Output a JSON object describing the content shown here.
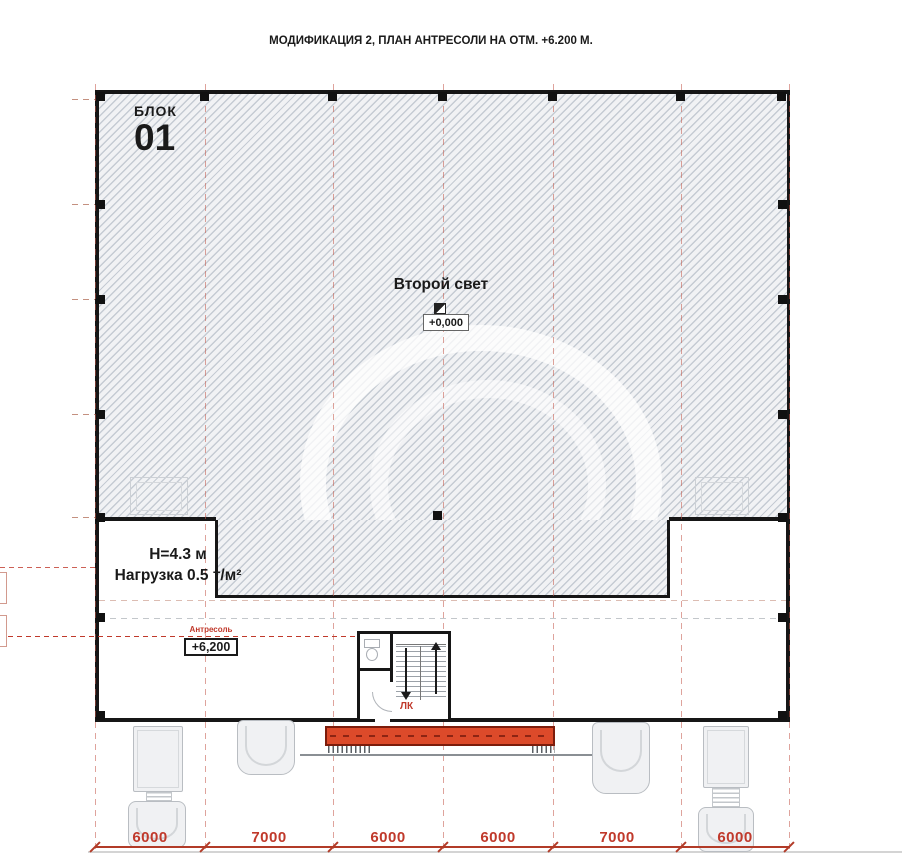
{
  "title": "МОДИФИКАЦИЯ 2, ПЛАН АНТРЕСОЛИ НА ОТМ. +6.200 М.",
  "block": {
    "label": "БЛОК",
    "number": "01"
  },
  "second_light": {
    "name": "Второй свет",
    "elevation": "+0,000"
  },
  "mezzanine": {
    "name": "Антресоль",
    "elevation": "+6,200",
    "height": "Н=4.3 м",
    "load": "Нагрузка 0.5 т/м²"
  },
  "stair": {
    "label": "ЛК"
  },
  "dimensions": {
    "bottom": [
      "6000",
      "7000",
      "6000",
      "6000",
      "7000",
      "6000"
    ],
    "left_clipped": [
      "1500",
      "1500"
    ]
  },
  "colors": {
    "wall": "#161616",
    "dimension_red": "#c0392b",
    "dock_fill": "#dc4a2a",
    "dock_border": "#7c1c0b",
    "hatch_line": "#c5cbd3",
    "truck_outline": "#b9bdc2"
  }
}
